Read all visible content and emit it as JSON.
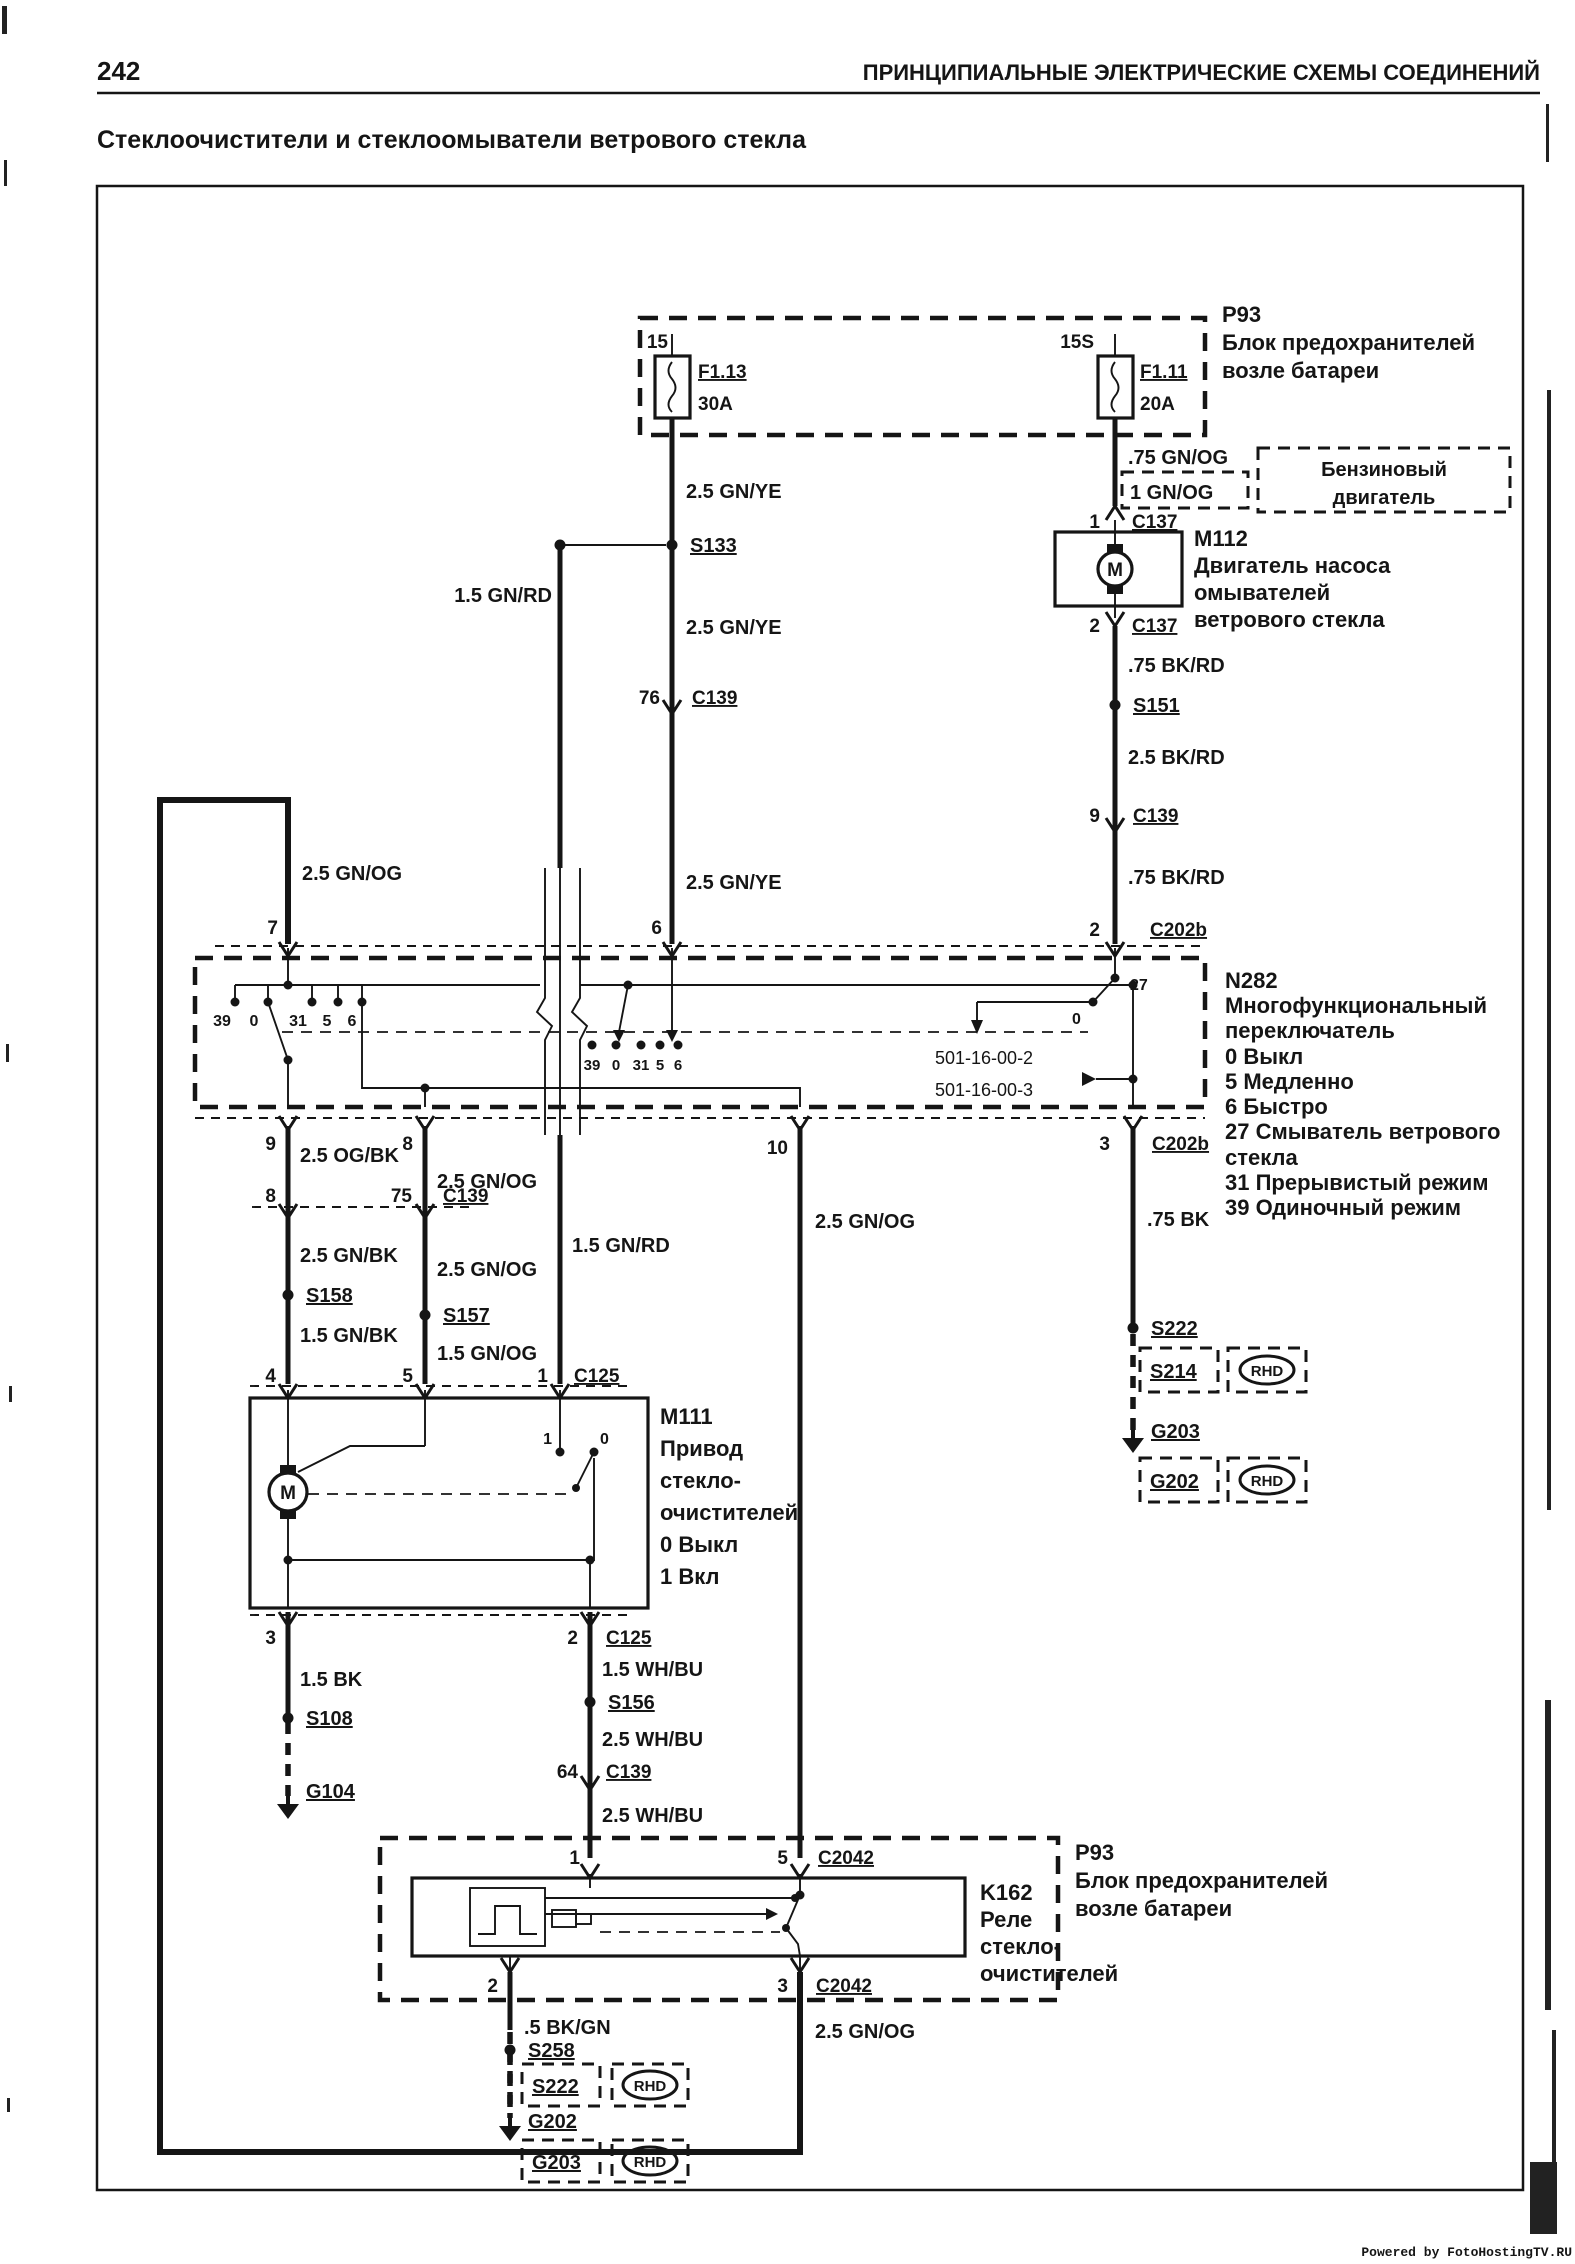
{
  "page": {
    "number": "242",
    "header": "ПРИНЦИПИАЛЬНЫЕ ЭЛЕКТРИЧЕСКИЕ СХЕМЫ СОЕДИНЕНИЙ",
    "title": "Стеклоочистители и стеклоомыватели ветрового стекла",
    "watermark": "Powered by FotoHostingTV.RU"
  },
  "colors": {
    "ink": "#151515",
    "paper": "#ffffff",
    "watermark": "#e0404e"
  },
  "fuse_box": {
    "id": "P93",
    "desc1": "Блок предохранителей",
    "desc2": "возле батареи",
    "fuse1": {
      "pin": "15",
      "name": "F1.13",
      "rating": "30A"
    },
    "fuse2": {
      "pin": "15S",
      "name": "F1.11",
      "rating": "20A"
    }
  },
  "engine_note": {
    "wire_a": ".75 GN/OG",
    "wire_b": "1 GN/OG",
    "line1": "Бензиновый",
    "line2": "двигатель"
  },
  "washer_motor": {
    "id": "M112",
    "desc": [
      "Двигатель насоса",
      "омывателей",
      "ветрового стекла"
    ],
    "motor_letter": "M"
  },
  "wiper_motor": {
    "id": "M111",
    "desc": [
      "Привод",
      "стекло-",
      "очистителей",
      "0 Выкл",
      "1 Вкл"
    ],
    "motor_letter": "M",
    "c1": "1",
    "c0": "0"
  },
  "switch": {
    "id": "N282",
    "desc": [
      "Многофункциональный",
      "переключатель",
      "0 Выкл",
      "5 Медленно",
      "6 Быстро",
      "27 Смыватель ветрового",
      "стекла",
      "31 Прерывистый режим",
      "39 Одиночный режим"
    ],
    "contacts": [
      "39",
      "0",
      "31",
      "5",
      "6"
    ],
    "c27": "27",
    "c0": "0",
    "ref1": "501-16-00-2",
    "ref2": "501-16-00-3"
  },
  "relay": {
    "id": "K162",
    "desc": [
      "Реле",
      "стекло-",
      "очистителей"
    ],
    "box_id": "P93",
    "box_desc1": "Блок предохранителей",
    "box_desc2": "возле батареи"
  },
  "wires": {
    "gnye": "2.5 GN/YE",
    "gnog": "2.5 GN/OG",
    "gnrd": "1.5 GN/RD",
    "bkrd075": ".75 BK/RD",
    "bkrd25": "2.5 BK/RD",
    "ogbk": "2.5 OG/BK",
    "gnbk25": "2.5 GN/BK",
    "gnbk15": "1.5 GN/BK",
    "gnog15": "1.5 GN/OG",
    "bk15": "1.5 BK",
    "whbu15": "1.5 WH/BU",
    "whbu25": "2.5 WH/BU",
    "bk075": ".75 BK",
    "bkgn": ".5 BK/GN"
  },
  "connectors": {
    "c137": "C137",
    "c139": "C139",
    "c125": "C125",
    "c202b": "C202b",
    "c2042": "C2042"
  },
  "pins": {
    "p0": "0",
    "p1": "1",
    "p2": "2",
    "p3": "3",
    "p4": "4",
    "p5": "5",
    "p6": "6",
    "p7": "7",
    "p8": "8",
    "p9": "9",
    "p10": "10",
    "p15": "15",
    "p15s": "15S",
    "p27": "27",
    "p64": "64",
    "p75": "75",
    "p76": "76"
  },
  "splices": {
    "s133": "S133",
    "s151": "S151",
    "s156": "S156",
    "s157": "S157",
    "s158": "S158",
    "s108": "S108",
    "s222": "S222",
    "s214": "S214",
    "s258": "S258"
  },
  "grounds": {
    "g104": "G104",
    "g202": "G202",
    "g203": "G203"
  },
  "rhd": "RHD"
}
